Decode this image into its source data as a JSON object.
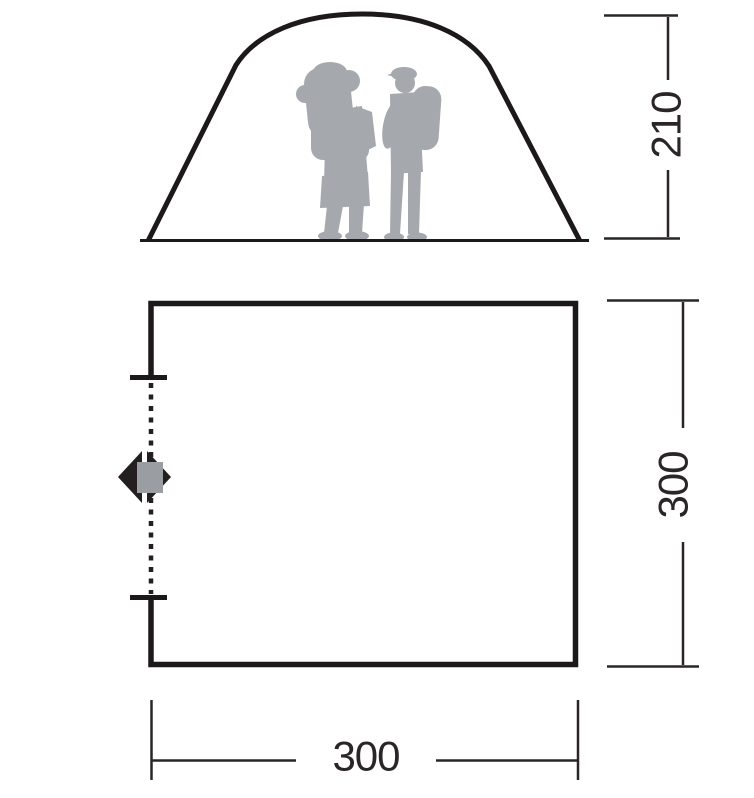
{
  "diagram": {
    "type": "tent-dimension-drawing",
    "elevation_view": {
      "name": "front elevation of dome tent",
      "figures": "two backpackers silhouette",
      "height_dimension": {
        "value": "210"
      }
    },
    "floor_plan_view": {
      "name": "floor plan of tent base",
      "door": {
        "symbol": "double-headed arrow",
        "opening_style": "dashed line with end ticks"
      },
      "depth_dimension": {
        "value": "300"
      },
      "width_dimension": {
        "value": "300"
      }
    },
    "colors": {
      "line": "#1d191a",
      "dimension_line": "#2a2627",
      "silhouette_gray": "#a5a9ae",
      "arrow_dark": "#231f20",
      "arrow_center_gray": "#9a9ea3",
      "background": "#ffffff"
    }
  }
}
